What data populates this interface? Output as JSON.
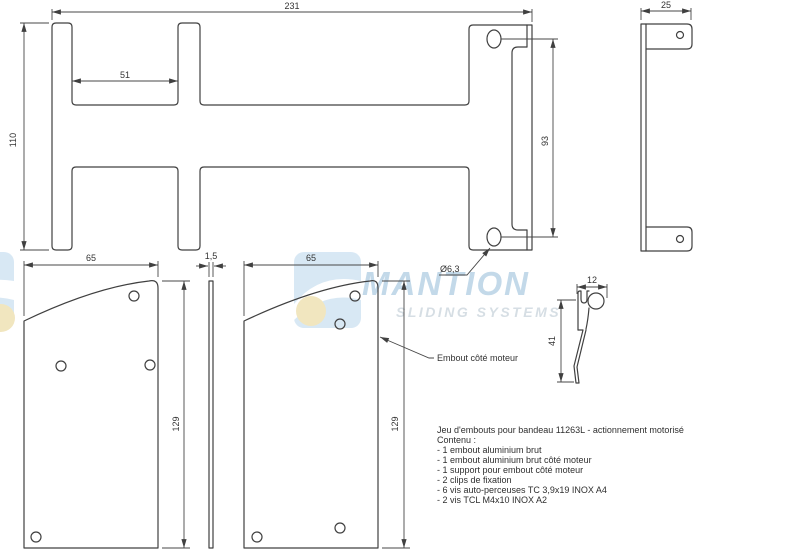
{
  "drawing": {
    "line_color": "#404040",
    "views": {
      "support_front": {
        "dims": {
          "width": "231",
          "slot": "51",
          "height": "110",
          "hole_spacing": "93",
          "hole_dia": "Ø6,3"
        }
      },
      "support_side": {
        "dims": {
          "width": "25"
        }
      },
      "endcap_plain": {
        "dims": {
          "width": "65",
          "height": "129"
        }
      },
      "spacer_strip": {
        "dims": {
          "thickness": "1,5"
        }
      },
      "endcap_motor": {
        "dims": {
          "width": "65",
          "height": "129"
        },
        "label": "Embout côté moteur"
      },
      "clip_profile": {
        "dims": {
          "width": "12",
          "height": "41"
        }
      }
    },
    "notes": {
      "title": "Jeu d'embouts pour bandeau 11263L - actionnement motorisé",
      "lines": [
        "Contenu :",
        "- 1 embout aluminium brut",
        "- 1 embout aluminium brut côté moteur",
        "- 1 support pour embout côté moteur",
        "- 2 clips de fixation",
        "- 6 vis auto-perceuses TC 3,9x19 INOX A4",
        "- 2 vis TCL M4x10 INOX A2"
      ]
    },
    "watermark": {
      "brand": "MANTION",
      "tagline": "SLIDING SYSTEMS",
      "brand_color": "#c0d7e8",
      "tagline_color": "#d4dde3",
      "logo_blue": "#d6e7f4",
      "logo_yellow": "#f1e5bc"
    }
  }
}
